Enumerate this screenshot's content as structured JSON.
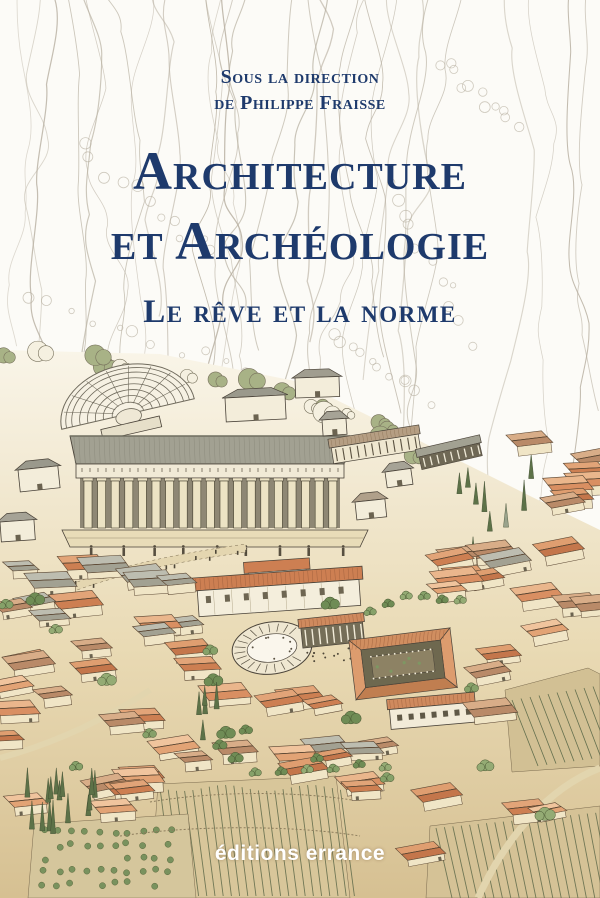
{
  "cover": {
    "direction_line1": "Sous la direction",
    "direction_line2": "de Philippe Fraisse",
    "title_line1": "Architecture",
    "title_line2": "et Archéologie",
    "subtitle": "Le rêve et la norme",
    "publisher": "éditions errance",
    "illustration_alt": "Panoramic reconstruction drawing of the sanctuary of Delphi: theatre, temple colonnade, treasuries and a terraced town of red-roofed houses with vineyards, orchards and cypresses below pencil-sketched cliffs"
  },
  "colors": {
    "title_blue": "#1e3a6c",
    "publisher_white": "#ffffff",
    "paper": "#fcfbf7",
    "pencil": "#b7afa0",
    "ink": "#4a4339",
    "wall_cream": "#f1e8d2",
    "roof_gray": "#a2a192",
    "roof_terracotta": "#cd7f52",
    "roof_salmon": "#e2a375",
    "tree_green": "#86a169",
    "cypress_green": "#5d7248",
    "ground_tan": "#d8c69a"
  }
}
